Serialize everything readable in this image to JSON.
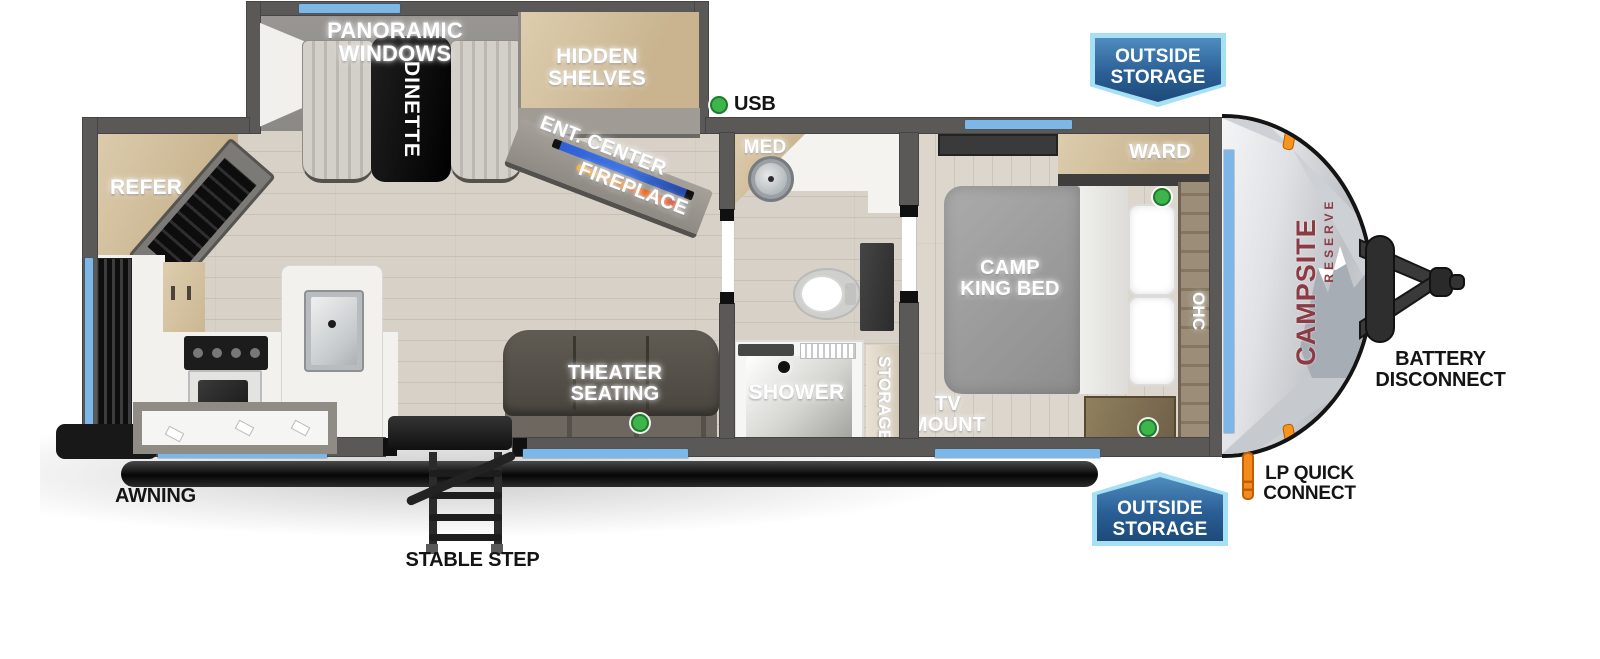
{
  "floorplan": {
    "slideout": {
      "panoramic_windows": "PANORAMIC WINDOWS",
      "dinette": "DINETTE",
      "hidden_shelves": "HIDDEN SHELVES"
    },
    "living": {
      "refer": "REFER",
      "ent_center": "ENT. CENTER",
      "fireplace": "FIREPLACE",
      "theater_seating": "THEATER SEATING"
    },
    "bathroom": {
      "med": "MED",
      "shower": "SHOWER",
      "storage": "STORAGE"
    },
    "bedroom": {
      "bed": "CAMP KING BED",
      "ward": "WARD",
      "ohc": "OHC",
      "tv_mount": "TV MOUNT"
    },
    "indicators": {
      "usb": "USB"
    },
    "exterior": {
      "outside_storage": "OUTSIDE STORAGE",
      "battery_disconnect": "BATTERY DISCONNECT",
      "lp_quick_connect": "LP QUICK CONNECT",
      "awning": "AWNING",
      "stable_step": "STABLE STEP"
    },
    "brand": {
      "name": "CAMPSITE",
      "series": "RESERVE"
    },
    "colors": {
      "window_accent_blue": "#7db7e8",
      "banner_blue": "#2a5f96",
      "banner_border_blue": "#a5e0f5",
      "usb_indicator_green": "#3db54a",
      "brand_red": "#8c3a44",
      "tv_strip_blue": "#2d5fd6",
      "fireplace_orange": "#f6a623"
    }
  }
}
